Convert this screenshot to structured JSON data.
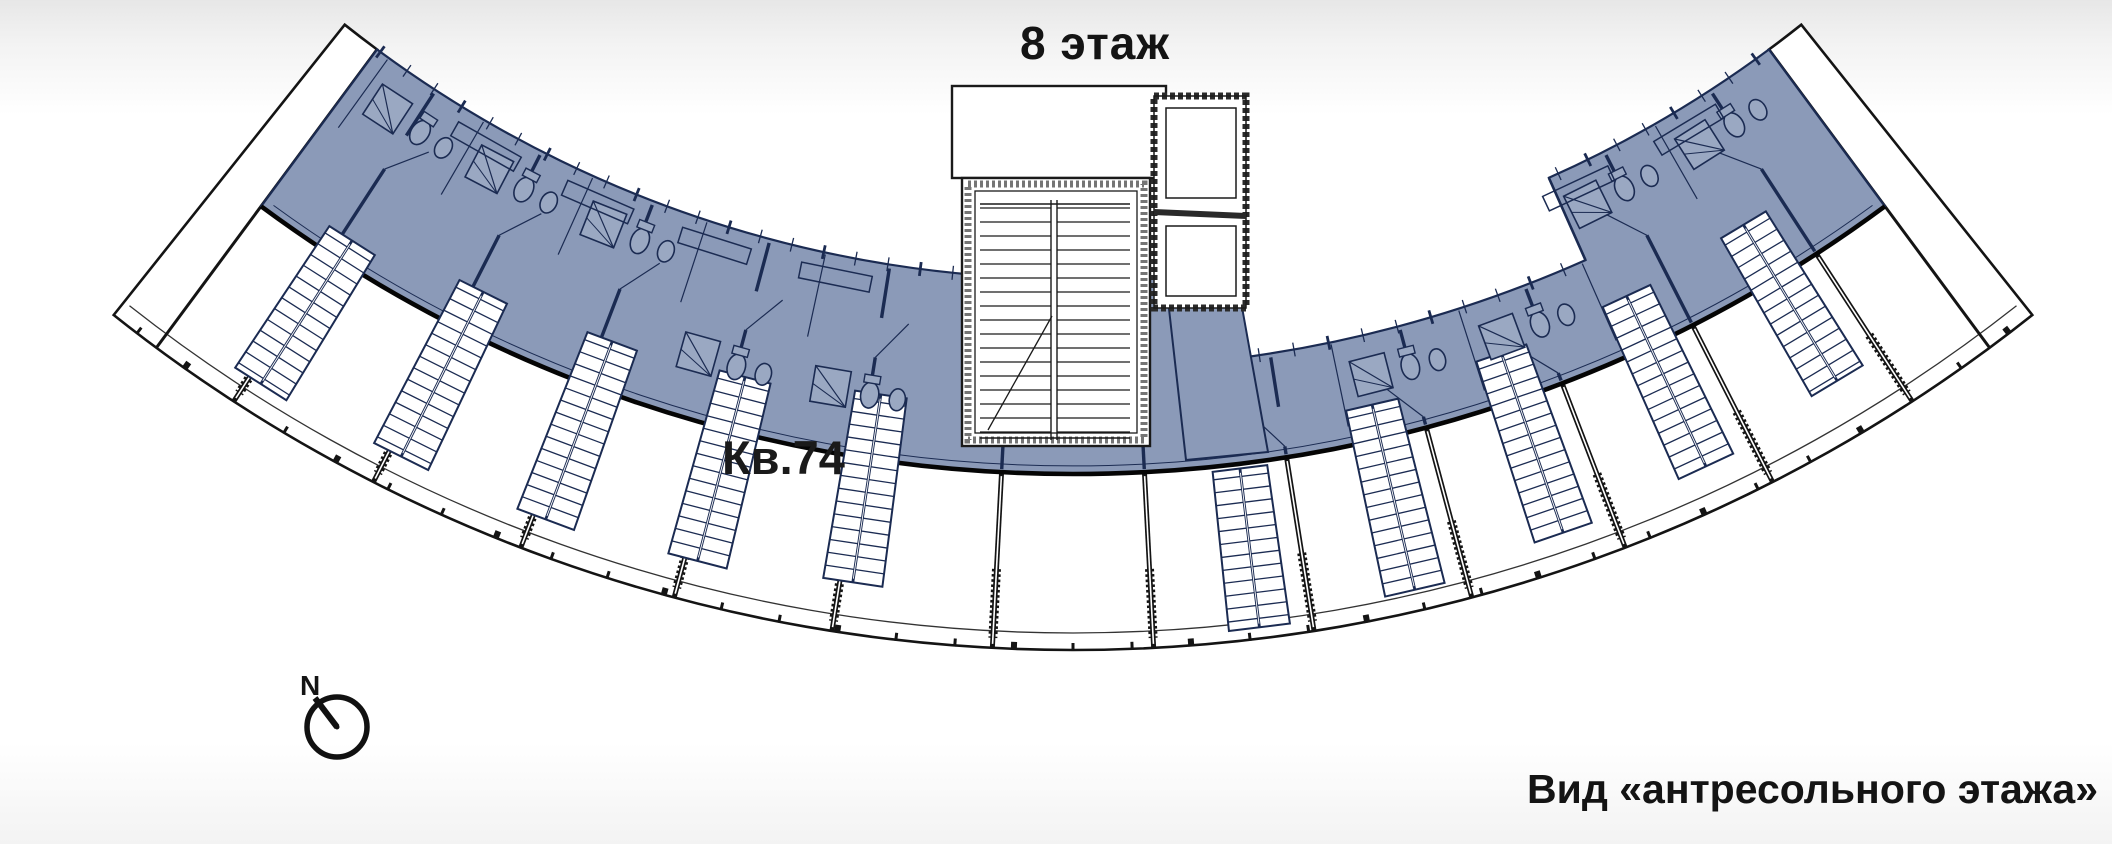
{
  "titles": {
    "floor": "8 этаж",
    "view": "Вид «антресольного этажа»"
  },
  "apartment": {
    "label": "Кв.74"
  },
  "compass": {
    "north_label": "N"
  },
  "colors": {
    "highlight": "#8B9AB8",
    "highlight_stroke": "#1B2B52",
    "fixture_fill": "#9AA8C2",
    "wall": "#141414",
    "hatch": "#666666",
    "white": "#ffffff",
    "text": "#141414",
    "bg_top": "#e7e7e7",
    "bg_bottom": "#f3f3f3"
  }
}
